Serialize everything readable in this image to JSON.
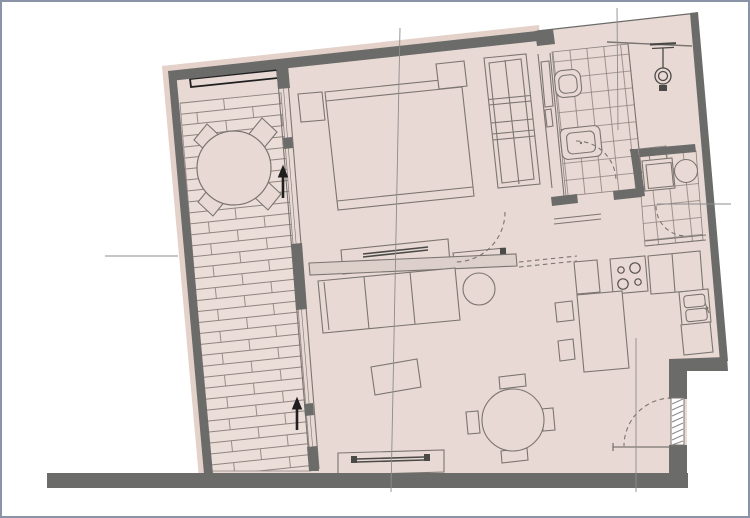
{
  "page": {
    "type": "architectural floor plan",
    "title": "apartment-floor-plan",
    "visible_text": []
  },
  "colors": {
    "background": "#ffffff",
    "frame_border": "#8b93a6",
    "room_fill": "#e9d9d4",
    "outer_face_fill": "#e4d1ca",
    "plank_fill": "#ebded8",
    "wall": "#6b6b69",
    "line": "#7b7570",
    "accent_black": "#1f1f1f",
    "reference_line": "#8c8c8c"
  },
  "rooms": [
    {
      "name": "balcony",
      "floor": "wood-planks",
      "items": [
        "round-table",
        "chair",
        "chair",
        "chair",
        "chair",
        "planter-box"
      ]
    },
    {
      "name": "bedroom",
      "items": [
        "double-bed",
        "nightstand-left",
        "nightstand-right",
        "wardrobe",
        "sideboard-with-tv",
        "shelf"
      ]
    },
    {
      "name": "bathroom",
      "floor": "tiles",
      "items": [
        "toilet",
        "washbasin",
        "shower-head"
      ]
    },
    {
      "name": "utility-room",
      "floor": "tiles",
      "items": [
        "appliance-square",
        "appliance-round"
      ]
    },
    {
      "name": "living-room",
      "items": [
        "sofa-3-seat",
        "round-side-table",
        "coffee-table",
        "round-dining-table",
        "dining-chair",
        "dining-chair",
        "dining-chair",
        "dining-chair",
        "tv-bench"
      ]
    },
    {
      "name": "kitchen",
      "items": [
        "counter",
        "cooktop-4-burners",
        "counter",
        "double-sink",
        "counter",
        "peninsula",
        "stool",
        "stool"
      ]
    }
  ],
  "openings": {
    "entrance_door_hatched": 1,
    "swing_door_arcs": 4,
    "sliding_pocket_door_dashed": 1,
    "balcony_glazing_with_arrows": 2
  },
  "reference_lines": {
    "vertical": 3,
    "horizontal": 2
  }
}
